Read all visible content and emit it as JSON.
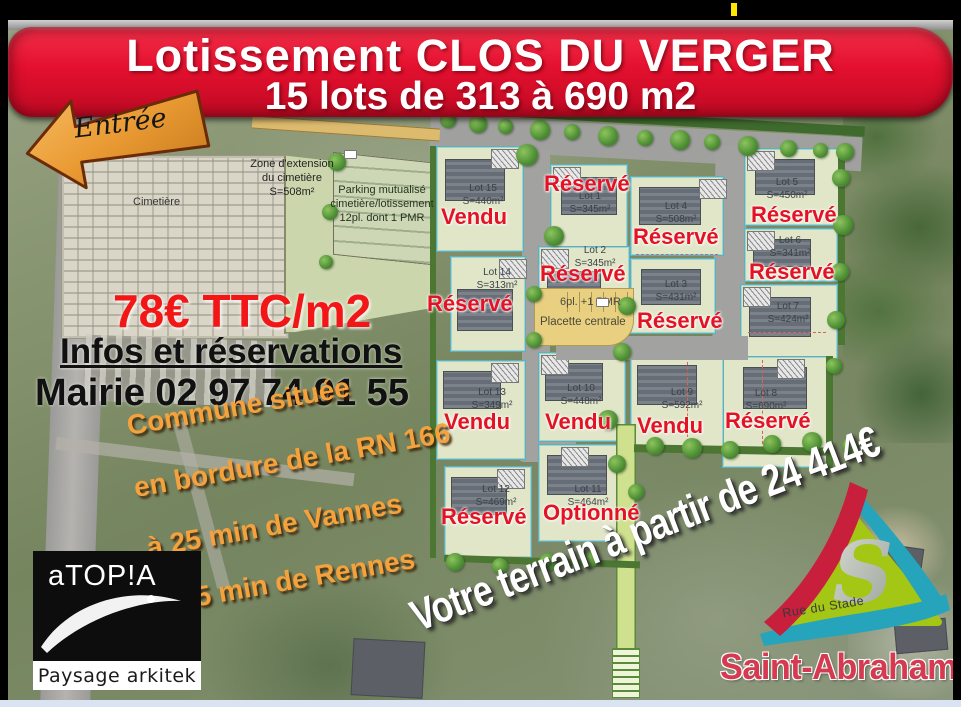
{
  "banner": {
    "title": "Lotissement CLOS DU VERGER",
    "subtitle": "15 lots de 313 à 690 m2"
  },
  "entrance_label": "Entrée",
  "streets": {
    "church": "Rue de l'Eglise",
    "stade": "Rue du Stade"
  },
  "cemetery": {
    "label": "Cimetière",
    "extension_lines": [
      "Zone d'extension",
      "du cimetière",
      "S=508m²"
    ],
    "parking_lines": [
      "Parking mutualisé",
      "cimetière/lotissement",
      "12pl. dont 1 PMR"
    ]
  },
  "pricing": {
    "price": "78€ TTC/m2",
    "info": "Infos et réservations",
    "contact": "Mairie 02 97 74 91 55"
  },
  "location_lines": [
    "Commune située",
    "en bordure de la RN 166",
    "à 25 min de Vannes",
    "à 45 min de Rennes"
  ],
  "promo": "Votre terrain à partir de 24 414€",
  "plan": {
    "placette": "Placette centrale",
    "parking_note": "6pl. +1 PMR",
    "lots": [
      {
        "name": "Lot 1",
        "area": "S=345m²",
        "status": "Réservé"
      },
      {
        "name": "Lot 2",
        "area": "S=345m²",
        "status": "Réservé"
      },
      {
        "name": "Lot 3",
        "area": "S=431m²",
        "status": "Réservé"
      },
      {
        "name": "Lot 4",
        "area": "S=508m²",
        "status": "Réservé"
      },
      {
        "name": "Lot 5",
        "area": "S=450m²",
        "status": "Réservé"
      },
      {
        "name": "Lot 6",
        "area": "S=341m²",
        "status": "Réservé"
      },
      {
        "name": "Lot 7",
        "area": "S=424m²",
        "status": ""
      },
      {
        "name": "Lot 8",
        "area": "S=690m²",
        "status": "Réservé"
      },
      {
        "name": "Lot 9",
        "area": "S=592m²",
        "status": "Vendu"
      },
      {
        "name": "Lot 10",
        "area": "S=448m²",
        "status": "Vendu"
      },
      {
        "name": "Lot 11",
        "area": "S=464m²",
        "status": "Optionné"
      },
      {
        "name": "Lot 12",
        "area": "S=469m²",
        "status": "Réservé"
      },
      {
        "name": "Lot 13",
        "area": "S=349m²",
        "status": "Vendu"
      },
      {
        "name": "Lot 14",
        "area": "S=313m²",
        "status": "Réservé"
      },
      {
        "name": "Lot 15",
        "area": "S=440m²",
        "status": "Vendu"
      }
    ]
  },
  "logos": {
    "designer": {
      "name": "aTOP!A",
      "tagline": "Paysage arkitek"
    },
    "commune": {
      "name": "Saint-Abraham"
    }
  },
  "colors": {
    "banner_red": "#e3102e",
    "status_red": "#e31325",
    "accent_orange": "#f5a23c",
    "parcel_border_cyan": "#3fb9e2",
    "placette_tan": "#e8d080",
    "cursor_yellow": "#ffe600"
  }
}
